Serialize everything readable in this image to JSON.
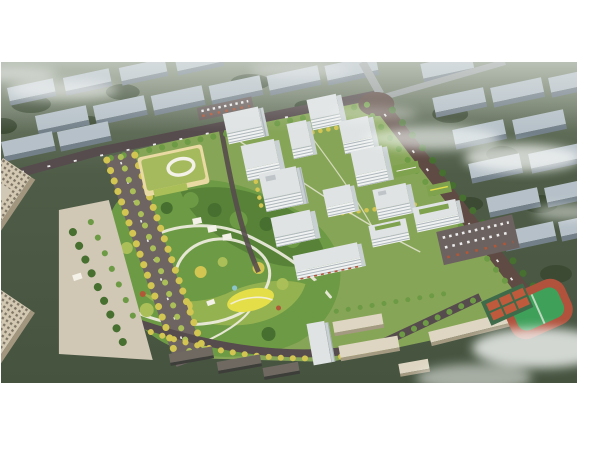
{
  "image": {
    "kind": "aerial-architectural-rendering",
    "subject": "residential-masterplan-birdseye"
  },
  "colors": {
    "page_bg": "#ffffff",
    "bg_top": "#7a8671",
    "bg_mid": "#4f5d48",
    "bg_deep": "#45533f",
    "bg_tree": "#394831",
    "slab_top": "#b5c0c8",
    "slab_side": "#73808a",
    "bg_road": "#9aa0a0",
    "avenue": "#5f4b44",
    "site_road": "#564b4d",
    "boulevard": "#6e6562",
    "parking": "#6c6260",
    "plaza": "#d0c7b5",
    "mist": "#f5f7f6",
    "haze": "#eef1ee",
    "tower_face": "#f0f2f2",
    "tower_side": "#c9d0d2",
    "tower_roof": "#dfe3e4",
    "tower_stripe": "#aeb7bb",
    "tower_glass": "#8c979d",
    "courtyard": "#87a557",
    "roof_garden": "#7ea24d",
    "meadow": "#e4de48",
    "path": "#f2efe3",
    "water": "#8ec9da",
    "tree_yellow": "#d2c551",
    "tree_lime": "#aabf57",
    "tree_green": "#6d9a44",
    "tree_dark": "#466f30",
    "accent_red": "#b25737",
    "kg_roof": "#a4ba5c",
    "kg_wall": "#e9d9a2",
    "white_trim": "#f4f1e8",
    "office_top": "#d3c9b3",
    "office_side": "#a2967f",
    "office_win": "#6a6253",
    "school_top": "#ded6c2",
    "school_side": "#a49a82",
    "lowrise_roof": "#6f6962",
    "lowrise_face": "#3d3d3a",
    "field_green": "#3fa05a",
    "track_red": "#b0523c",
    "court_red": "#c05a3c",
    "court_pad": "#3f6b4b",
    "car_white": "#ececec"
  },
  "scene": {
    "elements": [
      {
        "name": "background-city-blocks",
        "color": "slab_top"
      },
      {
        "name": "background-greenbelt",
        "color": "bg_mid"
      },
      {
        "name": "main-intersection",
        "color": "avenue"
      },
      {
        "name": "arterial-avenue",
        "color": "avenue"
      },
      {
        "name": "tree-lined-boulevard",
        "color": "boulevard"
      },
      {
        "name": "residential-towers",
        "color": "tower_face"
      },
      {
        "name": "courtyard-gardens",
        "color": "courtyard"
      },
      {
        "name": "central-park",
        "color": "tree_green"
      },
      {
        "name": "yellow-meadow",
        "color": "meadow"
      },
      {
        "name": "kindergarten",
        "color": "kg_roof"
      },
      {
        "name": "office-towers",
        "color": "office_top"
      },
      {
        "name": "west-plaza",
        "color": "plaza"
      },
      {
        "name": "school-campus",
        "color": "school_top"
      },
      {
        "name": "sports-field",
        "color": "field_green"
      },
      {
        "name": "running-track",
        "color": "track_red"
      },
      {
        "name": "basketball-courts",
        "color": "court_red"
      },
      {
        "name": "parking-lot",
        "color": "parking"
      },
      {
        "name": "mist-clouds",
        "color": "mist"
      }
    ]
  }
}
